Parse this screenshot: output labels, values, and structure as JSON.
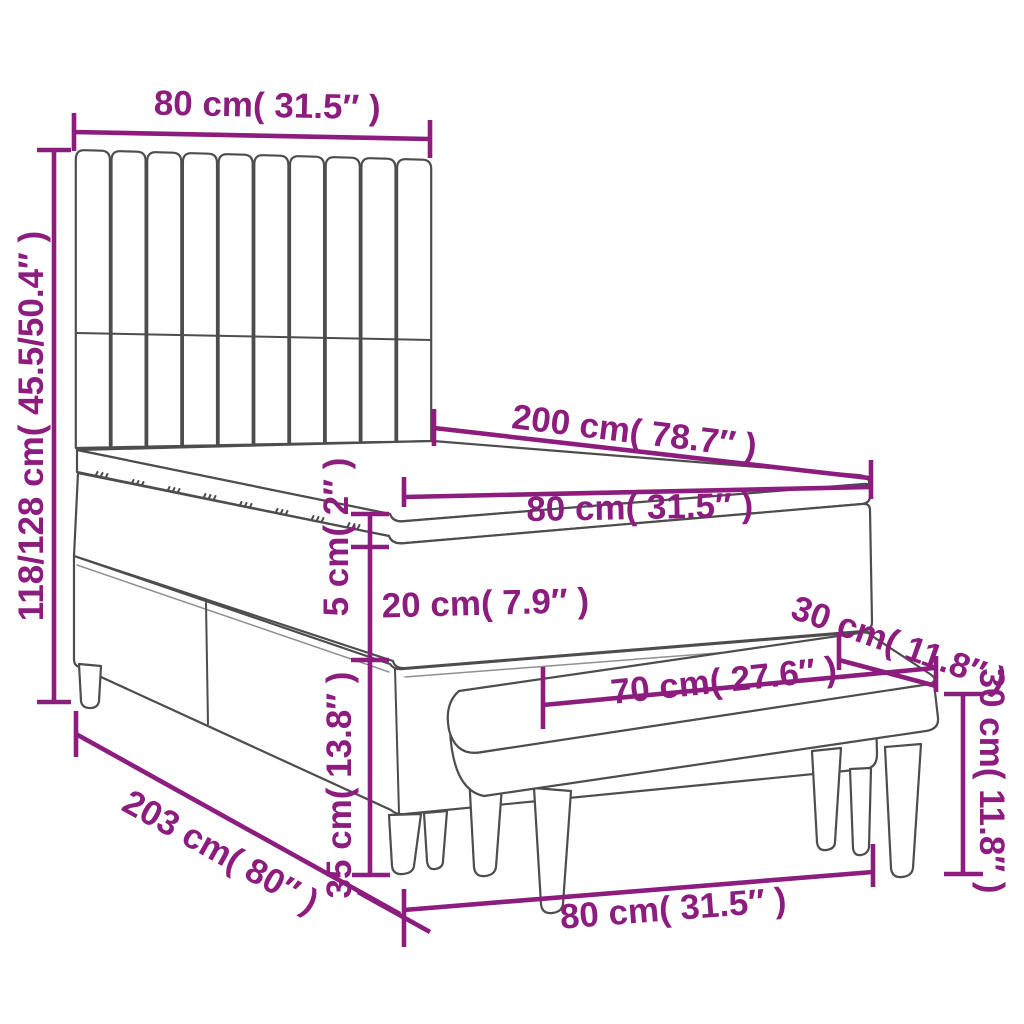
{
  "meta": {
    "title": "Box spring bed with headboard and bench — dimension diagram",
    "figure_type": "product-dimension-line-drawing"
  },
  "colors": {
    "annotation": "#8C1D7F",
    "line_art": "#4d4d4d",
    "background": "#ffffff"
  },
  "annotations": {
    "headboard_width": "80 cm( 31.5″ )",
    "total_height": "118/128 cm( 45.5/50.4″ )",
    "bed_length": "200 cm( 78.7″ )",
    "mattress_width": "80 cm( 31.5″ )",
    "topper_thickness": "5 cm( 2″ )",
    "mattress_thickness": "20 cm( 7.9″ )",
    "base_height": "35 cm( 13.8″ )",
    "bench_depth": "30 cm( 11.8″ )",
    "bench_length": "70 cm( 27.6″ )",
    "bench_height": "30 cm( 11.8″ )",
    "frame_length": "203 cm( 80″ )",
    "footprint_width": "80 cm( 31.5″ )"
  }
}
